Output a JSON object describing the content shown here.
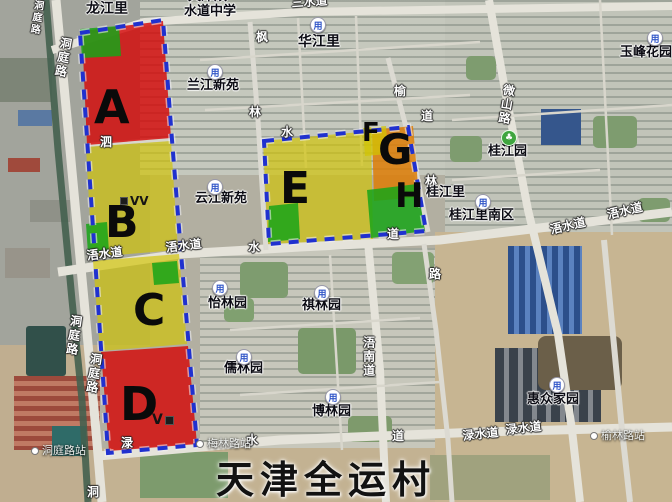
{
  "title": {
    "text": "天津全运村"
  },
  "colors": {
    "zone_red": "#d40808",
    "zone_yellow": "#d2c404",
    "zone_green": "#18a418",
    "zone_orange": "#dd7d06",
    "boundary_blue": "#2031cf"
  },
  "zones": [
    {
      "letter": "A",
      "x": 94,
      "y": 86,
      "size": 46
    },
    {
      "letter": "B",
      "x": 105,
      "y": 202,
      "size": 44
    },
    {
      "letter": "C",
      "x": 133,
      "y": 290,
      "size": 44
    },
    {
      "letter": "D",
      "x": 120,
      "y": 383,
      "size": 46
    },
    {
      "letter": "E",
      "x": 280,
      "y": 168,
      "size": 44
    },
    {
      "letter": "F",
      "x": 362,
      "y": 121,
      "size": 26
    },
    {
      "letter": "G",
      "x": 378,
      "y": 130,
      "size": 42
    },
    {
      "letter": "H",
      "x": 395,
      "y": 180,
      "size": 34
    }
  ],
  "marks": [
    {
      "text": "VV",
      "x": 120,
      "y": 194,
      "kind": "vv"
    },
    {
      "text": "V",
      "x": 152,
      "y": 412,
      "kind": "v"
    }
  ],
  "places": [
    {
      "text": "龙江里",
      "x": 86,
      "y": 2,
      "size": 14
    },
    {
      "text": "天津双",
      "x": 188,
      "y": -10,
      "size": 13
    },
    {
      "text": "水道中学",
      "x": 184,
      "y": 5,
      "size": 13
    },
    {
      "text": "华江里",
      "x": 298,
      "y": 35,
      "size": 14
    },
    {
      "text": "兰江新苑",
      "x": 187,
      "y": 79,
      "size": 13
    },
    {
      "text": "云江新苑",
      "x": 195,
      "y": 192,
      "size": 13
    },
    {
      "text": "怡林园",
      "x": 208,
      "y": 297,
      "size": 13
    },
    {
      "text": "祺林园",
      "x": 302,
      "y": 299,
      "size": 13
    },
    {
      "text": "儒林园",
      "x": 224,
      "y": 362,
      "size": 13
    },
    {
      "text": "博林园",
      "x": 312,
      "y": 405,
      "size": 13
    },
    {
      "text": "桂江园",
      "x": 488,
      "y": 145,
      "size": 13
    },
    {
      "text": "桂江里",
      "x": 426,
      "y": 186,
      "size": 13
    },
    {
      "text": "桂江里南区",
      "x": 449,
      "y": 209,
      "size": 13
    },
    {
      "text": "惠众家园",
      "x": 527,
      "y": 393,
      "size": 13
    },
    {
      "text": "玉峰花园",
      "x": 620,
      "y": 46,
      "size": 13
    }
  ],
  "poi_icons": [
    {
      "glyph": "用",
      "x": 310,
      "y": 17,
      "kind": "estate"
    },
    {
      "glyph": "用",
      "x": 207,
      "y": 64,
      "kind": "estate"
    },
    {
      "glyph": "用",
      "x": 207,
      "y": 179,
      "kind": "estate"
    },
    {
      "glyph": "用",
      "x": 212,
      "y": 280,
      "kind": "estate"
    },
    {
      "glyph": "用",
      "x": 314,
      "y": 285,
      "kind": "estate"
    },
    {
      "glyph": "用",
      "x": 236,
      "y": 349,
      "kind": "estate"
    },
    {
      "glyph": "用",
      "x": 325,
      "y": 389,
      "kind": "estate"
    },
    {
      "glyph": "用",
      "x": 475,
      "y": 194,
      "kind": "estate"
    },
    {
      "glyph": "用",
      "x": 549,
      "y": 377,
      "kind": "estate"
    },
    {
      "glyph": "用",
      "x": 647,
      "y": 30,
      "kind": "estate"
    },
    {
      "glyph": "♣",
      "x": 501,
      "y": 130,
      "kind": "tree"
    }
  ],
  "stations": [
    {
      "text": "洞庭路站",
      "x": 31,
      "y": 445
    },
    {
      "text": "梅林路站",
      "x": 196,
      "y": 438
    },
    {
      "text": "榆林路站",
      "x": 590,
      "y": 430
    }
  ],
  "road_labels": [
    {
      "text": "三水道",
      "x": 291,
      "y": -3,
      "rot": -4
    },
    {
      "text": "浯水道",
      "x": 86,
      "y": 250,
      "rot": -7
    },
    {
      "text": "浯水道",
      "x": 165,
      "y": 242,
      "rot": -7
    },
    {
      "text": "浯水道",
      "x": 549,
      "y": 224,
      "rot": -13
    },
    {
      "text": "浯水道",
      "x": 606,
      "y": 209,
      "rot": -13
    },
    {
      "text": "渌水道",
      "x": 462,
      "y": 430,
      "rot": -6
    },
    {
      "text": "渌水道",
      "x": 505,
      "y": 424,
      "rot": -6
    },
    {
      "text": "浯南道",
      "x": 362,
      "y": 336,
      "vert": true
    },
    {
      "text": "微山路",
      "x": 503,
      "y": 83,
      "vert": true,
      "rot": 9
    },
    {
      "text": "洞庭路",
      "x": 32,
      "y": -1,
      "vert": true,
      "rot": 8,
      "size": 10
    },
    {
      "text": "洞庭路",
      "x": 60,
      "y": 36,
      "vert": true,
      "rot": 10
    },
    {
      "text": "洞庭路",
      "x": 70,
      "y": 314,
      "vert": true,
      "rot": 8
    },
    {
      "text": "洞庭路",
      "x": 90,
      "y": 352,
      "vert": true,
      "rot": 8
    }
  ],
  "road_chars": [
    {
      "text": "泗",
      "x": 100,
      "y": 136
    },
    {
      "text": "枫",
      "x": 256,
      "y": 31
    },
    {
      "text": "林",
      "x": 249,
      "y": 106
    },
    {
      "text": "水",
      "x": 281,
      "y": 126
    },
    {
      "text": "水",
      "x": 248,
      "y": 241
    },
    {
      "text": "渌",
      "x": 121,
      "y": 437
    },
    {
      "text": "水",
      "x": 246,
      "y": 434
    },
    {
      "text": "道",
      "x": 392,
      "y": 430
    },
    {
      "text": "榆",
      "x": 394,
      "y": 85
    },
    {
      "text": "道",
      "x": 421,
      "y": 110
    },
    {
      "text": "林",
      "x": 425,
      "y": 175
    },
    {
      "text": "道",
      "x": 387,
      "y": 228
    },
    {
      "text": "路",
      "x": 429,
      "y": 268
    },
    {
      "text": "洞",
      "x": 87,
      "y": 486
    }
  ]
}
